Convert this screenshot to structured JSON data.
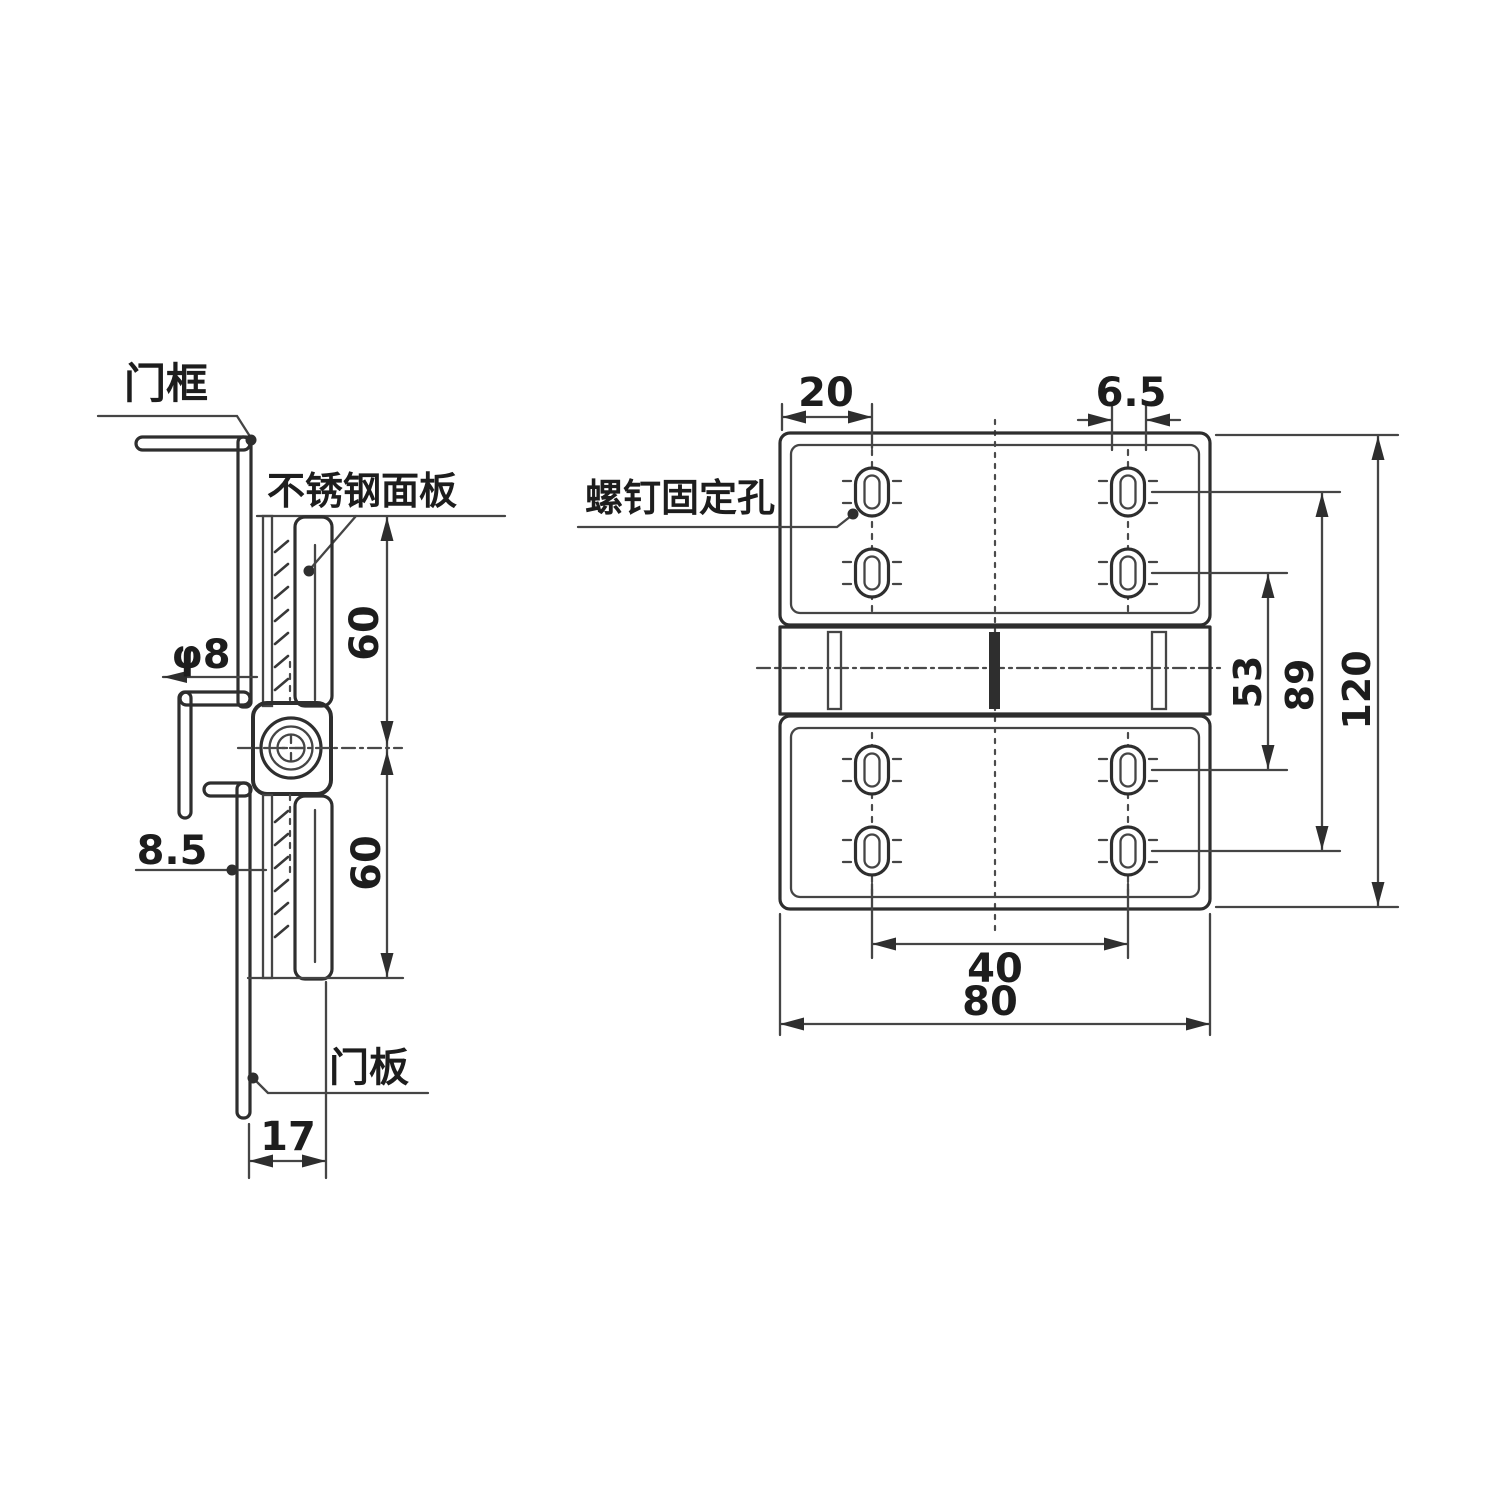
{
  "drawing": {
    "type": "hinge technical drawing",
    "background_color": "#ffffff",
    "line_color": "#2e2e2e"
  },
  "side_view": {
    "door_frame_label": "门框",
    "panel_label": "不锈钢面板",
    "pin_diameter": "φ8",
    "offset_dim": "8.5",
    "upper_height_dim": "60",
    "lower_height_dim": "60",
    "door_panel_label": "门板",
    "depth_dim": "17"
  },
  "front_view": {
    "screw_hole_label": "螺钉固定孔",
    "edge_to_hole_dim": "20",
    "slot_width_dim": "6.5",
    "inner_hole_span_dim": "53",
    "outer_hole_span_dim": "89",
    "total_height_dim": "120",
    "hole_spacing_dim": "40",
    "total_width_dim": "80"
  }
}
